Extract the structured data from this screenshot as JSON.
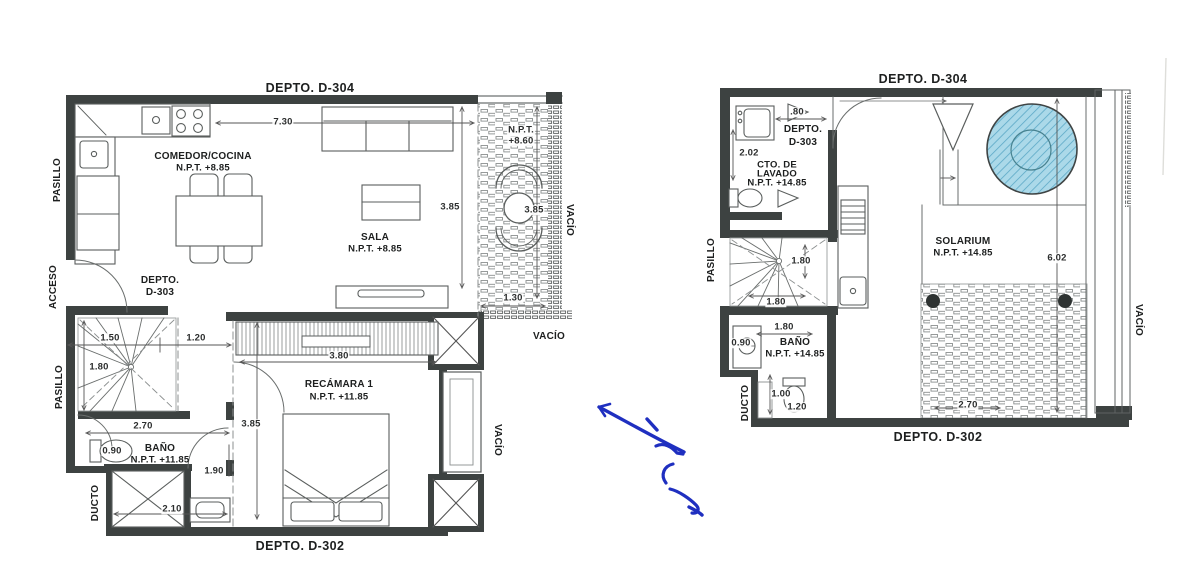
{
  "left_plan": {
    "neighbor_top": "DEPTO. D-304",
    "neighbor_bottom": "DEPTO. D-302",
    "unit_line1": "DEPTO.",
    "unit_line2": "D-303",
    "rooms": {
      "comedor_name": "COMEDOR/COCINA",
      "comedor_npt": "N.P.T. +8.85",
      "sala_name": "SALA",
      "sala_npt": "N.P.T. +8.85",
      "recamara_name": "RECÁMARA 1",
      "recamara_npt": "N.P.T. +11.85",
      "bano_name": "BAÑO",
      "bano_npt": "N.P.T. +11.85",
      "balcon_npt1": "N.P.T.",
      "balcon_npt2": "+8.60"
    },
    "edges": {
      "pasillo_top": "PASILLO",
      "acceso": "ACCESO",
      "pasillo_bottom": "PASILLO",
      "ducto": "DUCTO",
      "vacio_terrace": "VACÍO",
      "vacio_mid": "VACÍO",
      "vacio_right": "VACÍO"
    },
    "dims": {
      "width_total": "7.30",
      "sala_h": "3.85",
      "terrace_h": "3.85",
      "terrace_w": "1.30",
      "stair_w": "1.50",
      "hall_w": "1.20",
      "stair_h": "1.80",
      "bano_w": "2.70",
      "wc_w": "0.90",
      "door_w": "1.90",
      "recamara_w": "3.80",
      "recamara_h": "3.85",
      "shower_w": "2.10"
    }
  },
  "right_plan": {
    "neighbor_top": "DEPTO. D-304",
    "neighbor_bottom": "DEPTO. D-302",
    "unit_line1": "DEPTO.",
    "unit_line2": "D-303",
    "rooms": {
      "lavado_name1": "CTO. DE",
      "lavado_name2": "LAVADO",
      "lavado_npt": "N.P.T. +14.85",
      "solarium_name": "SOLARIUM",
      "solarium_npt": "N.P.T. +14.85",
      "bano_name": "BAÑO",
      "bano_npt": "N.P.T. +14.85"
    },
    "edges": {
      "pasillo": "PASILLO",
      "ducto": "DUCTO",
      "vacio_right": "VACÍO"
    },
    "dims": {
      "washer_w": ".80",
      "lavado_h": "2.02",
      "stair_run": "1.80",
      "stair_w": "1.80",
      "bano_w": "1.80",
      "bano_side": "0.90",
      "ducto_w": "1.00",
      "toilet_w": "1.20",
      "solarium_h": "6.02",
      "deck_w": "2.70"
    }
  }
}
